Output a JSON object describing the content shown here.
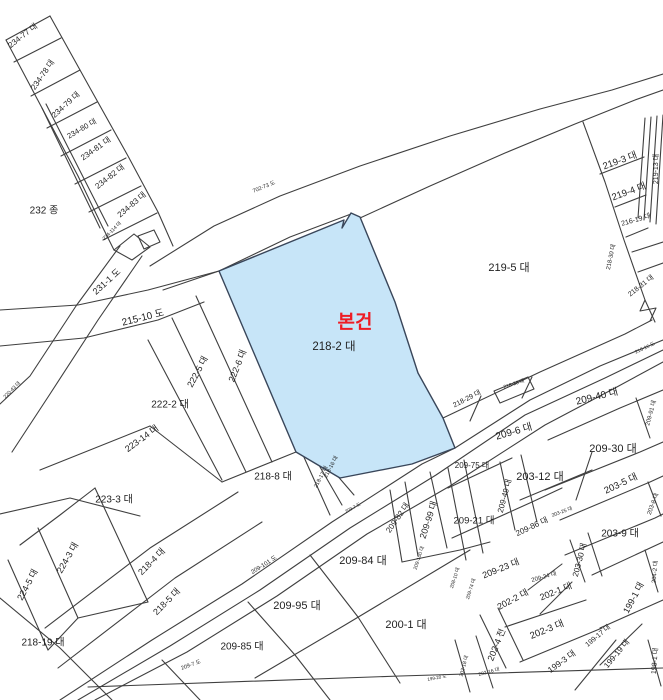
{
  "page": {
    "background": "#ffffff",
    "width": 663,
    "height": 700
  },
  "map": {
    "type": "cadastral-parcel-map",
    "line_color": "#3f3f3f",
    "text_color": "#1f1f1f",
    "subject": {
      "marker": "본건",
      "marker_color": "#ee1c25",
      "parcel": "218-2 대",
      "fill": "#c7e5f8",
      "stroke": "#39465a",
      "outline": "M219,271 L344,220 L342,228 L351,213 L360,217 L395,302 L418,373 L443,418 L455,448 L412,464 L340,478 L296,452 Z",
      "marker_x": 355,
      "marker_y": 328,
      "parcel_x": 334,
      "parcel_y": 350
    },
    "labels": [
      {
        "t": "234-77 대",
        "x": 23,
        "y": 36,
        "r": -38,
        "s": 8
      },
      {
        "t": "234-78 대",
        "x": 43,
        "y": 75,
        "r": -55,
        "s": 8
      },
      {
        "t": "234-79 대",
        "x": 66,
        "y": 105,
        "r": -42,
        "s": 8
      },
      {
        "t": "234-80 대",
        "x": 82,
        "y": 129,
        "r": -30,
        "s": 7.5
      },
      {
        "t": "234-81 대",
        "x": 96,
        "y": 149,
        "r": -35,
        "s": 8
      },
      {
        "t": "234-82 대",
        "x": 110,
        "y": 177,
        "r": -38,
        "s": 8
      },
      {
        "t": "234-83 대",
        "x": 132,
        "y": 205,
        "r": -40,
        "s": 8
      },
      {
        "t": "232 종",
        "x": 44,
        "y": 211,
        "r": 0,
        "s": 10
      },
      {
        "t": "234-114 대",
        "x": 112,
        "y": 231,
        "r": -45,
        "s": 5
      },
      {
        "t": "231-1 도",
        "x": 107,
        "y": 282,
        "r": -42,
        "s": 9
      },
      {
        "t": "215-10 도",
        "x": 143,
        "y": 318,
        "r": -14,
        "s": 10
      },
      {
        "t": "702-73 도",
        "x": 264,
        "y": 187,
        "r": -22,
        "s": 5.5
      },
      {
        "t": "219-5 대",
        "x": 509,
        "y": 268,
        "r": 0,
        "s": 11
      },
      {
        "t": "219-3 대",
        "x": 620,
        "y": 161,
        "r": -20,
        "s": 9.5
      },
      {
        "t": "219-4 대",
        "x": 629,
        "y": 192,
        "r": -20,
        "s": 9.5
      },
      {
        "t": "216-19 대",
        "x": 636,
        "y": 220,
        "r": -16,
        "s": 7
      },
      {
        "t": "219-13 대",
        "x": 656,
        "y": 169,
        "r": -90,
        "s": 7
      },
      {
        "t": "218-30 대",
        "x": 611,
        "y": 257,
        "r": -78,
        "s": 6
      },
      {
        "t": "218-31 대",
        "x": 641,
        "y": 286,
        "r": -38,
        "s": 7
      },
      {
        "t": "218-16 도",
        "x": 645,
        "y": 348,
        "r": -25,
        "s": 5
      },
      {
        "t": "222-6 대",
        "x": 238,
        "y": 366,
        "r": -68,
        "s": 9
      },
      {
        "t": "222-5 대",
        "x": 198,
        "y": 372,
        "r": -62,
        "s": 9
      },
      {
        "t": "222-2 대",
        "x": 170,
        "y": 405,
        "r": 0,
        "s": 10
      },
      {
        "t": "223-14 대",
        "x": 142,
        "y": 439,
        "r": -36,
        "s": 9
      },
      {
        "t": "223-3 대",
        "x": 114,
        "y": 500,
        "r": 0,
        "s": 10
      },
      {
        "t": "224-3 대",
        "x": 68,
        "y": 558,
        "r": -60,
        "s": 9
      },
      {
        "t": "224-5 대",
        "x": 28,
        "y": 585,
        "r": -62,
        "s": 9
      },
      {
        "t": "218-4 대",
        "x": 152,
        "y": 562,
        "r": -45,
        "s": 9
      },
      {
        "t": "218-5 대",
        "x": 167,
        "y": 602,
        "r": -45,
        "s": 9
      },
      {
        "t": "218-19 대",
        "x": 43,
        "y": 643,
        "r": 0,
        "s": 10
      },
      {
        "t": "218-8 대",
        "x": 273,
        "y": 477,
        "r": 0,
        "s": 10
      },
      {
        "t": "218-16 대",
        "x": 331,
        "y": 467,
        "r": -62,
        "s": 5.5
      },
      {
        "t": "218-17 대",
        "x": 321,
        "y": 477,
        "r": -62,
        "s": 5.5
      },
      {
        "t": "218-29 대",
        "x": 467,
        "y": 399,
        "r": -27,
        "s": 7
      },
      {
        "t": "218-38 대",
        "x": 514,
        "y": 384,
        "r": -18,
        "s": 5
      },
      {
        "t": "209-101 도",
        "x": 264,
        "y": 565,
        "r": -32,
        "s": 6
      },
      {
        "t": "209-7 도",
        "x": 191,
        "y": 665,
        "r": -20,
        "s": 5.5
      },
      {
        "t": "209-7 도",
        "x": 353,
        "y": 508,
        "r": -28,
        "s": 4.5
      },
      {
        "t": "209-85 대",
        "x": 242,
        "y": 647,
        "r": 0,
        "s": 10
      },
      {
        "t": "209-95 대",
        "x": 297,
        "y": 606,
        "r": 0,
        "s": 11
      },
      {
        "t": "209-84 대",
        "x": 363,
        "y": 561,
        "r": 0,
        "s": 11
      },
      {
        "t": "200-1 대",
        "x": 406,
        "y": 625,
        "r": 0,
        "s": 11
      },
      {
        "t": "209-99 대",
        "x": 429,
        "y": 520,
        "r": -72,
        "s": 9
      },
      {
        "t": "209-100 대",
        "x": 419,
        "y": 558,
        "r": -72,
        "s": 5
      },
      {
        "t": "209-82 대",
        "x": 398,
        "y": 518,
        "r": -55,
        "s": 8
      },
      {
        "t": "208-10 대",
        "x": 455,
        "y": 578,
        "r": -72,
        "s": 5
      },
      {
        "t": "209-74 대",
        "x": 471,
        "y": 589,
        "r": -72,
        "s": 5
      },
      {
        "t": "209-75 대",
        "x": 472,
        "y": 466,
        "r": 0,
        "s": 8
      },
      {
        "t": "209-21 대",
        "x": 474,
        "y": 521,
        "r": 0,
        "s": 9.5
      },
      {
        "t": "209-6 대",
        "x": 514,
        "y": 432,
        "r": -16,
        "s": 10
      },
      {
        "t": "209-40 대",
        "x": 597,
        "y": 397,
        "r": -14,
        "s": 10
      },
      {
        "t": "209-91 대",
        "x": 651,
        "y": 413,
        "r": -75,
        "s": 6
      },
      {
        "t": "209-30 대",
        "x": 613,
        "y": 449,
        "r": 0,
        "s": 11
      },
      {
        "t": "203-12 대",
        "x": 540,
        "y": 477,
        "r": 0,
        "s": 11
      },
      {
        "t": "209-49 대",
        "x": 505,
        "y": 496,
        "r": -75,
        "s": 8
      },
      {
        "t": "203-5 대",
        "x": 621,
        "y": 484,
        "r": -25,
        "s": 9.5
      },
      {
        "t": "203-25 대",
        "x": 562,
        "y": 512,
        "r": -20,
        "s": 5
      },
      {
        "t": "209-86 대",
        "x": 532,
        "y": 527,
        "r": -25,
        "s": 8
      },
      {
        "t": "203-8 대",
        "x": 653,
        "y": 504,
        "r": -70,
        "s": 6
      },
      {
        "t": "203-9 대",
        "x": 620,
        "y": 534,
        "r": 0,
        "s": 10
      },
      {
        "t": "209-23 대",
        "x": 501,
        "y": 569,
        "r": -22,
        "s": 9
      },
      {
        "t": "209-24 대",
        "x": 544,
        "y": 577,
        "r": -16,
        "s": 6
      },
      {
        "t": "203-30 대",
        "x": 580,
        "y": 560,
        "r": -75,
        "s": 8
      },
      {
        "t": "202-1 대",
        "x": 556,
        "y": 592,
        "r": -22,
        "s": 9
      },
      {
        "t": "202-2 대",
        "x": 513,
        "y": 600,
        "r": -28,
        "s": 9
      },
      {
        "t": "202-3 대",
        "x": 547,
        "y": 630,
        "r": -22,
        "s": 9.5
      },
      {
        "t": "202-4 전",
        "x": 497,
        "y": 645,
        "r": -68,
        "s": 9
      },
      {
        "t": "204-2 대",
        "x": 655,
        "y": 572,
        "r": -85,
        "s": 6
      },
      {
        "t": "199-1 대",
        "x": 634,
        "y": 598,
        "r": -62,
        "s": 9
      },
      {
        "t": "199-17 대",
        "x": 598,
        "y": 636,
        "r": -40,
        "s": 7
      },
      {
        "t": "199-19 대",
        "x": 617,
        "y": 654,
        "r": -50,
        "s": 8
      },
      {
        "t": "199-3 대",
        "x": 562,
        "y": 662,
        "r": -36,
        "s": 8.5
      },
      {
        "t": "198-1 대",
        "x": 655,
        "y": 661,
        "r": -85,
        "s": 7
      },
      {
        "t": "202-18 대",
        "x": 464,
        "y": 666,
        "r": -75,
        "s": 5
      },
      {
        "t": "202-16 대",
        "x": 489,
        "y": 672,
        "r": -15,
        "s": 5
      },
      {
        "t": "220-43 대",
        "x": 12,
        "y": 390,
        "r": -45,
        "s": 5
      },
      {
        "t": "199-20 도",
        "x": 437,
        "y": 678,
        "r": -10,
        "s": 4.5
      }
    ],
    "boundaries": [
      "M88,687 L400,676 L663,668",
      "M6,40 L42,108 L78,176 L102,226 L114,250",
      "M50,16 L90,88 L128,156 L158,212 L173,246",
      "M6,40 L50,16",
      "M14,62 L61,38",
      "M31,96 L80,70",
      "M47,128 L97,102",
      "M61,156 L111,130",
      "M75,184 L126,158",
      "M89,212 L141,186",
      "M103,240 L157,213",
      "M42,108 L100,228",
      "M46,104 L108,226",
      "M114,250 L134,234 L150,247 L132,260 Z",
      "M138,236 L154,230 L160,242 L144,249 Z",
      "M120,246 L76,306 L30,376 L0,404",
      "M142,256 L98,320 L50,394 L12,452",
      "M0,310 L78,305 L148,290 L219,271",
      "M0,346 L84,338 L158,320 L204,302",
      "M150,266 L214,226 L280,196 L360,166 L450,136 L540,109 L612,90 L663,74",
      "M163,290 L219,271 L290,237 L351,214",
      "M360,218 L430,186 L505,153 L575,124 L635,100 L663,90",
      "M583,122 L605,182 L624,240 L645,300 L655,322",
      "M600,174 L644,157",
      "M615,207 L646,195",
      "M626,237 L648,228",
      "M645,118 L638,218",
      "M651,117 L644,220",
      "M657,116 L650,222",
      "M663,115 L656,224",
      "M632,252 L663,242",
      "M638,272 L663,263",
      "M645,300 L640,311 L656,308 L650,321",
      "M443,418 L540,372 L625,334 L652,320",
      "M470,421 L481,396",
      "M522,398 L532,377",
      "M494,391 L528,377 L534,389 L500,403 Z",
      "M60,700 L152,640 L242,584 L332,522 L422,464 L455,448 L530,400 L600,366 L663,340",
      "M78,700 L170,646 L260,590 L350,528 L436,475 L525,415 L605,378 L663,350",
      "M95,700 L187,652 L277,596 L367,534 L450,486 L545,425 L615,388 L663,362",
      "M196,296 L272,462",
      "M172,318 L246,472",
      "M148,340 L222,480",
      "M40,470 L150,426",
      "M150,426 L222,482",
      "M222,482 L296,452",
      "M0,514 L70,498 L140,516",
      "M20,545 L60,515 L95,488",
      "M38,528 L78,618",
      "M8,560 L48,650",
      "M78,618 L48,650",
      "M95,488 L148,602",
      "M148,602 L78,618",
      "M0,598 L60,648 L112,700",
      "M45,628 L150,548 L238,492",
      "M58,668 L175,578 L262,522",
      "M303,455 L330,515",
      "M316,460 L342,505",
      "M329,466 L354,495",
      "M162,660 L200,700",
      "M248,602 L295,655 L330,700",
      "M310,555 L358,617 L400,683",
      "M255,678 L345,625 L440,568 L470,550",
      "M405,482 L418,556",
      "M430,472 L447,548",
      "M390,490 L402,562",
      "M402,562 L460,550 L490,542",
      "M448,468 L466,560",
      "M464,460 L483,553",
      "M448,488 L512,458",
      "M452,538 L532,502 L562,488",
      "M500,462 L515,530",
      "M521,455 L537,522",
      "M520,500 L592,470",
      "M576,500 L592,452",
      "M548,440 L620,408 L663,390",
      "M636,398 L650,438",
      "M545,490 L640,452 L663,442",
      "M560,520 L650,482 L663,476",
      "M648,482 L661,516",
      "M565,555 L655,518 L663,514",
      "M570,540 L585,582",
      "M588,533 L602,576",
      "M592,575 L663,542",
      "M645,550 L658,592",
      "M600,628 L663,600",
      "M600,665 L642,624",
      "M575,690 L616,640",
      "M648,640 L661,686",
      "M528,590 L562,564",
      "M540,614 L572,582",
      "M505,627 L586,600",
      "M520,662 L602,628",
      "M480,615 L506,668",
      "M498,608 L523,660",
      "M455,640 L470,692",
      "M476,636 L493,688"
    ]
  }
}
